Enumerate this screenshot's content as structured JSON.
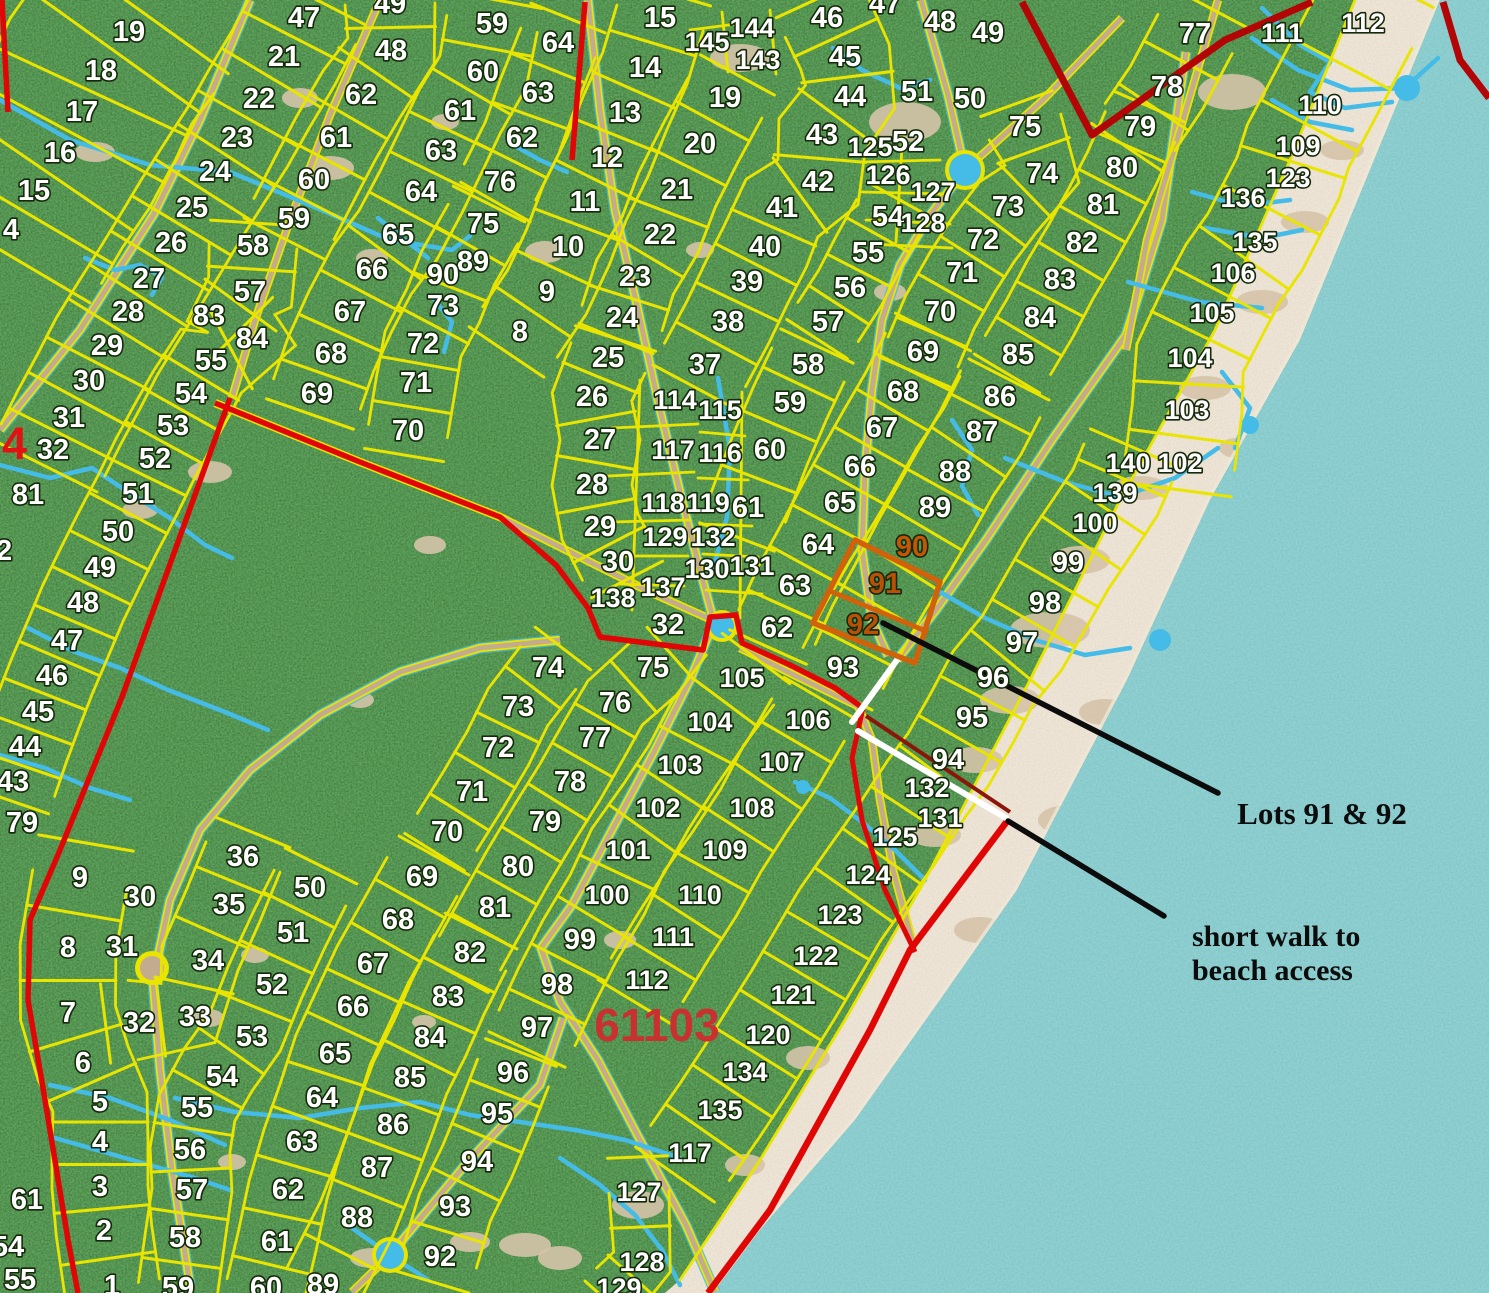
{
  "annotations": {
    "lots_callout": "Lots 91 & 92",
    "beach_callout_line1": "short walk to",
    "beach_callout_line2": "beach access",
    "parcel_number": "61103",
    "boundary_number": "4"
  },
  "colors": {
    "forest": "#1e4217",
    "water": "#3f9a9d",
    "sand": "#d5c3a8",
    "lot_line_yellow": "#e9e400",
    "boundary_red": "#e00606",
    "boundary_dark_red": "#b30505",
    "creek_blue": "#45bbe8",
    "road_tan": "#c2ab8e",
    "highlight_orange": "#d2620a",
    "highlight_text_orange": "#b85106",
    "annotation_black": "#0c0c0c",
    "lot_number_white": "#ffffff",
    "parcel_red": "#c93131"
  },
  "highlight": {
    "lots": [
      "91",
      "92"
    ]
  },
  "lot_labels": [
    {
      "t": "19",
      "x": 129,
      "y": 32
    },
    {
      "t": "18",
      "x": 101,
      "y": 71
    },
    {
      "t": "17",
      "x": 82,
      "y": 112
    },
    {
      "t": "16",
      "x": 60,
      "y": 153
    },
    {
      "t": "15",
      "x": 34,
      "y": 191
    },
    {
      "t": "4",
      "x": 11,
      "y": 230
    },
    {
      "t": "47",
      "x": 304,
      "y": 18
    },
    {
      "t": "21",
      "x": 284,
      "y": 57
    },
    {
      "t": "22",
      "x": 259,
      "y": 99
    },
    {
      "t": "23",
      "x": 237,
      "y": 138
    },
    {
      "t": "24",
      "x": 215,
      "y": 172
    },
    {
      "t": "25",
      "x": 192,
      "y": 208
    },
    {
      "t": "26",
      "x": 171,
      "y": 243
    },
    {
      "t": "27",
      "x": 149,
      "y": 279
    },
    {
      "t": "28",
      "x": 128,
      "y": 312
    },
    {
      "t": "29",
      "x": 107,
      "y": 346
    },
    {
      "t": "30",
      "x": 89,
      "y": 381
    },
    {
      "t": "31",
      "x": 69,
      "y": 418
    },
    {
      "t": "32",
      "x": 53,
      "y": 450
    },
    {
      "t": "49",
      "x": 390,
      "y": 4
    },
    {
      "t": "48",
      "x": 391,
      "y": 51
    },
    {
      "t": "62",
      "x": 361,
      "y": 95
    },
    {
      "t": "61",
      "x": 336,
      "y": 138
    },
    {
      "t": "60",
      "x": 314,
      "y": 180
    },
    {
      "t": "59",
      "x": 294,
      "y": 219
    },
    {
      "t": "58",
      "x": 253,
      "y": 246
    },
    {
      "t": "57",
      "x": 250,
      "y": 292
    },
    {
      "t": "83",
      "x": 209,
      "y": 316
    },
    {
      "t": "84",
      "x": 252,
      "y": 339
    },
    {
      "t": "55",
      "x": 211,
      "y": 361
    },
    {
      "t": "54",
      "x": 191,
      "y": 394
    },
    {
      "t": "53",
      "x": 173,
      "y": 426
    },
    {
      "t": "52",
      "x": 155,
      "y": 459
    },
    {
      "t": "51",
      "x": 138,
      "y": 494
    },
    {
      "t": "50",
      "x": 118,
      "y": 532
    },
    {
      "t": "49",
      "x": 100,
      "y": 568
    },
    {
      "t": "48",
      "x": 83,
      "y": 603
    },
    {
      "t": "47",
      "x": 67,
      "y": 641
    },
    {
      "t": "46",
      "x": 52,
      "y": 676
    },
    {
      "t": "45",
      "x": 38,
      "y": 712
    },
    {
      "t": "44",
      "x": 25,
      "y": 747
    },
    {
      "t": "43",
      "x": 13,
      "y": 782
    },
    {
      "t": "81",
      "x": 28,
      "y": 495
    },
    {
      "t": "2",
      "x": 4,
      "y": 551
    },
    {
      "t": "79",
      "x": 22,
      "y": 823
    },
    {
      "t": "59",
      "x": 492,
      "y": 24
    },
    {
      "t": "60",
      "x": 483,
      "y": 72
    },
    {
      "t": "61",
      "x": 460,
      "y": 111
    },
    {
      "t": "63",
      "x": 441,
      "y": 151
    },
    {
      "t": "64",
      "x": 421,
      "y": 192
    },
    {
      "t": "65",
      "x": 398,
      "y": 235
    },
    {
      "t": "66",
      "x": 372,
      "y": 270
    },
    {
      "t": "67",
      "x": 350,
      "y": 312
    },
    {
      "t": "68",
      "x": 331,
      "y": 354
    },
    {
      "t": "69",
      "x": 317,
      "y": 394
    },
    {
      "t": "70",
      "x": 408,
      "y": 431
    },
    {
      "t": "71",
      "x": 416,
      "y": 383
    },
    {
      "t": "72",
      "x": 423,
      "y": 344
    },
    {
      "t": "73",
      "x": 443,
      "y": 306
    },
    {
      "t": "75",
      "x": 483,
      "y": 224
    },
    {
      "t": "89",
      "x": 473,
      "y": 262
    },
    {
      "t": "90",
      "x": 443,
      "y": 275
    },
    {
      "t": "64",
      "x": 558,
      "y": 43
    },
    {
      "t": "63",
      "x": 538,
      "y": 93
    },
    {
      "t": "62",
      "x": 522,
      "y": 138
    },
    {
      "t": "76",
      "x": 500,
      "y": 182
    },
    {
      "t": "15",
      "x": 660,
      "y": 18
    },
    {
      "t": "14",
      "x": 645,
      "y": 68
    },
    {
      "t": "13",
      "x": 625,
      "y": 113
    },
    {
      "t": "12",
      "x": 607,
      "y": 158
    },
    {
      "t": "11",
      "x": 585,
      "y": 202
    },
    {
      "t": "10",
      "x": 568,
      "y": 247
    },
    {
      "t": "9",
      "x": 547,
      "y": 292
    },
    {
      "t": "8",
      "x": 520,
      "y": 332
    },
    {
      "t": "145",
      "x": 707,
      "y": 42
    },
    {
      "t": "144",
      "x": 752,
      "y": 28
    },
    {
      "t": "143",
      "x": 758,
      "y": 60
    },
    {
      "t": "19",
      "x": 725,
      "y": 98
    },
    {
      "t": "20",
      "x": 700,
      "y": 144
    },
    {
      "t": "21",
      "x": 677,
      "y": 190
    },
    {
      "t": "22",
      "x": 660,
      "y": 235
    },
    {
      "t": "23",
      "x": 635,
      "y": 277
    },
    {
      "t": "24",
      "x": 622,
      "y": 318
    },
    {
      "t": "46",
      "x": 827,
      "y": 18
    },
    {
      "t": "45",
      "x": 845,
      "y": 57
    },
    {
      "t": "44",
      "x": 850,
      "y": 97
    },
    {
      "t": "43",
      "x": 822,
      "y": 135
    },
    {
      "t": "42",
      "x": 818,
      "y": 182
    },
    {
      "t": "41",
      "x": 782,
      "y": 208
    },
    {
      "t": "40",
      "x": 765,
      "y": 247
    },
    {
      "t": "39",
      "x": 747,
      "y": 282
    },
    {
      "t": "38",
      "x": 728,
      "y": 322
    },
    {
      "t": "37",
      "x": 705,
      "y": 365
    },
    {
      "t": "47",
      "x": 885,
      "y": 4
    },
    {
      "t": "48",
      "x": 940,
      "y": 22
    },
    {
      "t": "49",
      "x": 988,
      "y": 33
    },
    {
      "t": "51",
      "x": 917,
      "y": 92
    },
    {
      "t": "50",
      "x": 970,
      "y": 99
    },
    {
      "t": "125",
      "x": 870,
      "y": 147
    },
    {
      "t": "52",
      "x": 908,
      "y": 142
    },
    {
      "t": "126",
      "x": 888,
      "y": 175
    },
    {
      "t": "127",
      "x": 933,
      "y": 192
    },
    {
      "t": "54",
      "x": 888,
      "y": 217
    },
    {
      "t": "128",
      "x": 923,
      "y": 223
    },
    {
      "t": "55",
      "x": 868,
      "y": 253
    },
    {
      "t": "56",
      "x": 850,
      "y": 288
    },
    {
      "t": "57",
      "x": 828,
      "y": 322
    },
    {
      "t": "75",
      "x": 1025,
      "y": 127
    },
    {
      "t": "74",
      "x": 1042,
      "y": 174
    },
    {
      "t": "73",
      "x": 1008,
      "y": 207
    },
    {
      "t": "72",
      "x": 983,
      "y": 240
    },
    {
      "t": "71",
      "x": 962,
      "y": 273
    },
    {
      "t": "70",
      "x": 940,
      "y": 312
    },
    {
      "t": "69",
      "x": 923,
      "y": 352
    },
    {
      "t": "79",
      "x": 1140,
      "y": 127
    },
    {
      "t": "80",
      "x": 1122,
      "y": 168
    },
    {
      "t": "81",
      "x": 1103,
      "y": 205
    },
    {
      "t": "82",
      "x": 1082,
      "y": 243
    },
    {
      "t": "83",
      "x": 1060,
      "y": 280
    },
    {
      "t": "84",
      "x": 1040,
      "y": 318
    },
    {
      "t": "85",
      "x": 1018,
      "y": 355
    },
    {
      "t": "77",
      "x": 1195,
      "y": 34
    },
    {
      "t": "78",
      "x": 1167,
      "y": 87
    },
    {
      "t": "111",
      "x": 1282,
      "y": 33
    },
    {
      "t": "112",
      "x": 1363,
      "y": 23
    },
    {
      "t": "110",
      "x": 1320,
      "y": 105
    },
    {
      "t": "109",
      "x": 1298,
      "y": 146
    },
    {
      "t": "123",
      "x": 1288,
      "y": 178
    },
    {
      "t": "136",
      "x": 1243,
      "y": 198
    },
    {
      "t": "135",
      "x": 1255,
      "y": 242
    },
    {
      "t": "106",
      "x": 1233,
      "y": 273
    },
    {
      "t": "105",
      "x": 1212,
      "y": 313
    },
    {
      "t": "104",
      "x": 1190,
      "y": 358
    },
    {
      "t": "103",
      "x": 1187,
      "y": 410
    },
    {
      "t": "102",
      "x": 1180,
      "y": 463
    },
    {
      "t": "140",
      "x": 1128,
      "y": 463
    },
    {
      "t": "139",
      "x": 1115,
      "y": 493
    },
    {
      "t": "100",
      "x": 1095,
      "y": 523
    },
    {
      "t": "99",
      "x": 1068,
      "y": 563
    },
    {
      "t": "98",
      "x": 1045,
      "y": 603
    },
    {
      "t": "97",
      "x": 1022,
      "y": 643
    },
    {
      "t": "25",
      "x": 608,
      "y": 358
    },
    {
      "t": "26",
      "x": 592,
      "y": 397
    },
    {
      "t": "27",
      "x": 600,
      "y": 440
    },
    {
      "t": "28",
      "x": 592,
      "y": 485
    },
    {
      "t": "29",
      "x": 600,
      "y": 527
    },
    {
      "t": "30",
      "x": 618,
      "y": 562
    },
    {
      "t": "137",
      "x": 663,
      "y": 587
    },
    {
      "t": "138",
      "x": 613,
      "y": 598
    },
    {
      "t": "32",
      "x": 668,
      "y": 625
    },
    {
      "t": "114",
      "x": 675,
      "y": 400
    },
    {
      "t": "115",
      "x": 720,
      "y": 410
    },
    {
      "t": "117",
      "x": 673,
      "y": 450
    },
    {
      "t": "116",
      "x": 720,
      "y": 453
    },
    {
      "t": "118",
      "x": 663,
      "y": 503
    },
    {
      "t": "119",
      "x": 708,
      "y": 503
    },
    {
      "t": "129",
      "x": 665,
      "y": 537
    },
    {
      "t": "132",
      "x": 713,
      "y": 537
    },
    {
      "t": "130",
      "x": 707,
      "y": 569
    },
    {
      "t": "131",
      "x": 752,
      "y": 566
    },
    {
      "t": "58",
      "x": 808,
      "y": 365
    },
    {
      "t": "59",
      "x": 790,
      "y": 403
    },
    {
      "t": "60",
      "x": 770,
      "y": 450
    },
    {
      "t": "61",
      "x": 748,
      "y": 508
    },
    {
      "t": "64",
      "x": 818,
      "y": 545
    },
    {
      "t": "63",
      "x": 795,
      "y": 586
    },
    {
      "t": "62",
      "x": 777,
      "y": 628
    },
    {
      "t": "68",
      "x": 903,
      "y": 392
    },
    {
      "t": "67",
      "x": 882,
      "y": 428
    },
    {
      "t": "66",
      "x": 860,
      "y": 467
    },
    {
      "t": "65",
      "x": 840,
      "y": 503
    },
    {
      "t": "86",
      "x": 1000,
      "y": 397
    },
    {
      "t": "87",
      "x": 982,
      "y": 432
    },
    {
      "t": "88",
      "x": 955,
      "y": 472
    },
    {
      "t": "89",
      "x": 935,
      "y": 508
    },
    {
      "t": "90",
      "x": 912,
      "y": 547,
      "c": "#c05606"
    },
    {
      "t": "91",
      "x": 885,
      "y": 584,
      "c": "#b85106"
    },
    {
      "t": "92",
      "x": 863,
      "y": 625,
      "c": "#b85106"
    },
    {
      "t": "93",
      "x": 843,
      "y": 668
    },
    {
      "t": "96",
      "x": 993,
      "y": 678
    },
    {
      "t": "95",
      "x": 972,
      "y": 718
    },
    {
      "t": "94",
      "x": 948,
      "y": 760
    },
    {
      "t": "132",
      "x": 927,
      "y": 788
    },
    {
      "t": "131",
      "x": 940,
      "y": 818
    },
    {
      "t": "125",
      "x": 895,
      "y": 837
    },
    {
      "t": "124",
      "x": 868,
      "y": 875
    },
    {
      "t": "74",
      "x": 548,
      "y": 668
    },
    {
      "t": "75",
      "x": 653,
      "y": 668
    },
    {
      "t": "105",
      "x": 742,
      "y": 678
    },
    {
      "t": "73",
      "x": 518,
      "y": 707
    },
    {
      "t": "76",
      "x": 615,
      "y": 703
    },
    {
      "t": "104",
      "x": 710,
      "y": 722
    },
    {
      "t": "106",
      "x": 808,
      "y": 720
    },
    {
      "t": "72",
      "x": 498,
      "y": 748
    },
    {
      "t": "77",
      "x": 595,
      "y": 738
    },
    {
      "t": "103",
      "x": 680,
      "y": 765
    },
    {
      "t": "107",
      "x": 782,
      "y": 762
    },
    {
      "t": "71",
      "x": 472,
      "y": 792
    },
    {
      "t": "78",
      "x": 570,
      "y": 782
    },
    {
      "t": "102",
      "x": 658,
      "y": 808
    },
    {
      "t": "108",
      "x": 752,
      "y": 808
    },
    {
      "t": "70",
      "x": 447,
      "y": 832
    },
    {
      "t": "79",
      "x": 545,
      "y": 822
    },
    {
      "t": "101",
      "x": 628,
      "y": 850
    },
    {
      "t": "109",
      "x": 725,
      "y": 850
    },
    {
      "t": "80",
      "x": 518,
      "y": 867
    },
    {
      "t": "100",
      "x": 607,
      "y": 895
    },
    {
      "t": "110",
      "x": 700,
      "y": 895
    },
    {
      "t": "81",
      "x": 495,
      "y": 908
    },
    {
      "t": "99",
      "x": 580,
      "y": 940
    },
    {
      "t": "111",
      "x": 673,
      "y": 937
    },
    {
      "t": "82",
      "x": 470,
      "y": 953
    },
    {
      "t": "98",
      "x": 557,
      "y": 985
    },
    {
      "t": "112",
      "x": 647,
      "y": 980
    },
    {
      "t": "123",
      "x": 840,
      "y": 915
    },
    {
      "t": "122",
      "x": 816,
      "y": 956
    },
    {
      "t": "121",
      "x": 793,
      "y": 995
    },
    {
      "t": "120",
      "x": 768,
      "y": 1035
    },
    {
      "t": "134",
      "x": 745,
      "y": 1072
    },
    {
      "t": "135",
      "x": 720,
      "y": 1110
    },
    {
      "t": "117",
      "x": 690,
      "y": 1153
    },
    {
      "t": "127",
      "x": 639,
      "y": 1192
    },
    {
      "t": "128",
      "x": 642,
      "y": 1262
    },
    {
      "t": "129",
      "x": 619,
      "y": 1288
    },
    {
      "t": "97",
      "x": 537,
      "y": 1028
    },
    {
      "t": "96",
      "x": 513,
      "y": 1073
    },
    {
      "t": "95",
      "x": 497,
      "y": 1114
    },
    {
      "t": "94",
      "x": 477,
      "y": 1162
    },
    {
      "t": "93",
      "x": 455,
      "y": 1207
    },
    {
      "t": "92",
      "x": 440,
      "y": 1257
    },
    {
      "t": "9",
      "x": 80,
      "y": 878
    },
    {
      "t": "8",
      "x": 68,
      "y": 948
    },
    {
      "t": "7",
      "x": 68,
      "y": 1013
    },
    {
      "t": "6",
      "x": 83,
      "y": 1063
    },
    {
      "t": "5",
      "x": 100,
      "y": 1102
    },
    {
      "t": "4",
      "x": 100,
      "y": 1142
    },
    {
      "t": "3",
      "x": 100,
      "y": 1187
    },
    {
      "t": "2",
      "x": 104,
      "y": 1231
    },
    {
      "t": "1",
      "x": 112,
      "y": 1286
    },
    {
      "t": "36",
      "x": 243,
      "y": 857
    },
    {
      "t": "35",
      "x": 229,
      "y": 905
    },
    {
      "t": "34",
      "x": 208,
      "y": 961
    },
    {
      "t": "33",
      "x": 195,
      "y": 1017
    },
    {
      "t": "31",
      "x": 122,
      "y": 947
    },
    {
      "t": "32",
      "x": 139,
      "y": 1023
    },
    {
      "t": "30",
      "x": 140,
      "y": 897
    },
    {
      "t": "50",
      "x": 310,
      "y": 888
    },
    {
      "t": "51",
      "x": 293,
      "y": 933
    },
    {
      "t": "52",
      "x": 272,
      "y": 985
    },
    {
      "t": "53",
      "x": 252,
      "y": 1037
    },
    {
      "t": "54",
      "x": 222,
      "y": 1077
    },
    {
      "t": "55",
      "x": 197,
      "y": 1108
    },
    {
      "t": "56",
      "x": 190,
      "y": 1150
    },
    {
      "t": "57",
      "x": 192,
      "y": 1190
    },
    {
      "t": "58",
      "x": 185,
      "y": 1238
    },
    {
      "t": "59",
      "x": 178,
      "y": 1288
    },
    {
      "t": "69",
      "x": 422,
      "y": 877
    },
    {
      "t": "68",
      "x": 398,
      "y": 920
    },
    {
      "t": "67",
      "x": 373,
      "y": 964
    },
    {
      "t": "66",
      "x": 353,
      "y": 1007
    },
    {
      "t": "65",
      "x": 335,
      "y": 1054
    },
    {
      "t": "64",
      "x": 322,
      "y": 1098
    },
    {
      "t": "63",
      "x": 302,
      "y": 1142
    },
    {
      "t": "62",
      "x": 288,
      "y": 1190
    },
    {
      "t": "61",
      "x": 277,
      "y": 1242
    },
    {
      "t": "60",
      "x": 266,
      "y": 1288
    },
    {
      "t": "83",
      "x": 448,
      "y": 997
    },
    {
      "t": "84",
      "x": 430,
      "y": 1038
    },
    {
      "t": "85",
      "x": 410,
      "y": 1078
    },
    {
      "t": "86",
      "x": 393,
      "y": 1125
    },
    {
      "t": "87",
      "x": 377,
      "y": 1168
    },
    {
      "t": "88",
      "x": 357,
      "y": 1218
    },
    {
      "t": "89",
      "x": 323,
      "y": 1285
    },
    {
      "t": "61",
      "x": 27,
      "y": 1200
    },
    {
      "t": "54",
      "x": 8,
      "y": 1247
    },
    {
      "t": "55",
      "x": 20,
      "y": 1280
    }
  ]
}
